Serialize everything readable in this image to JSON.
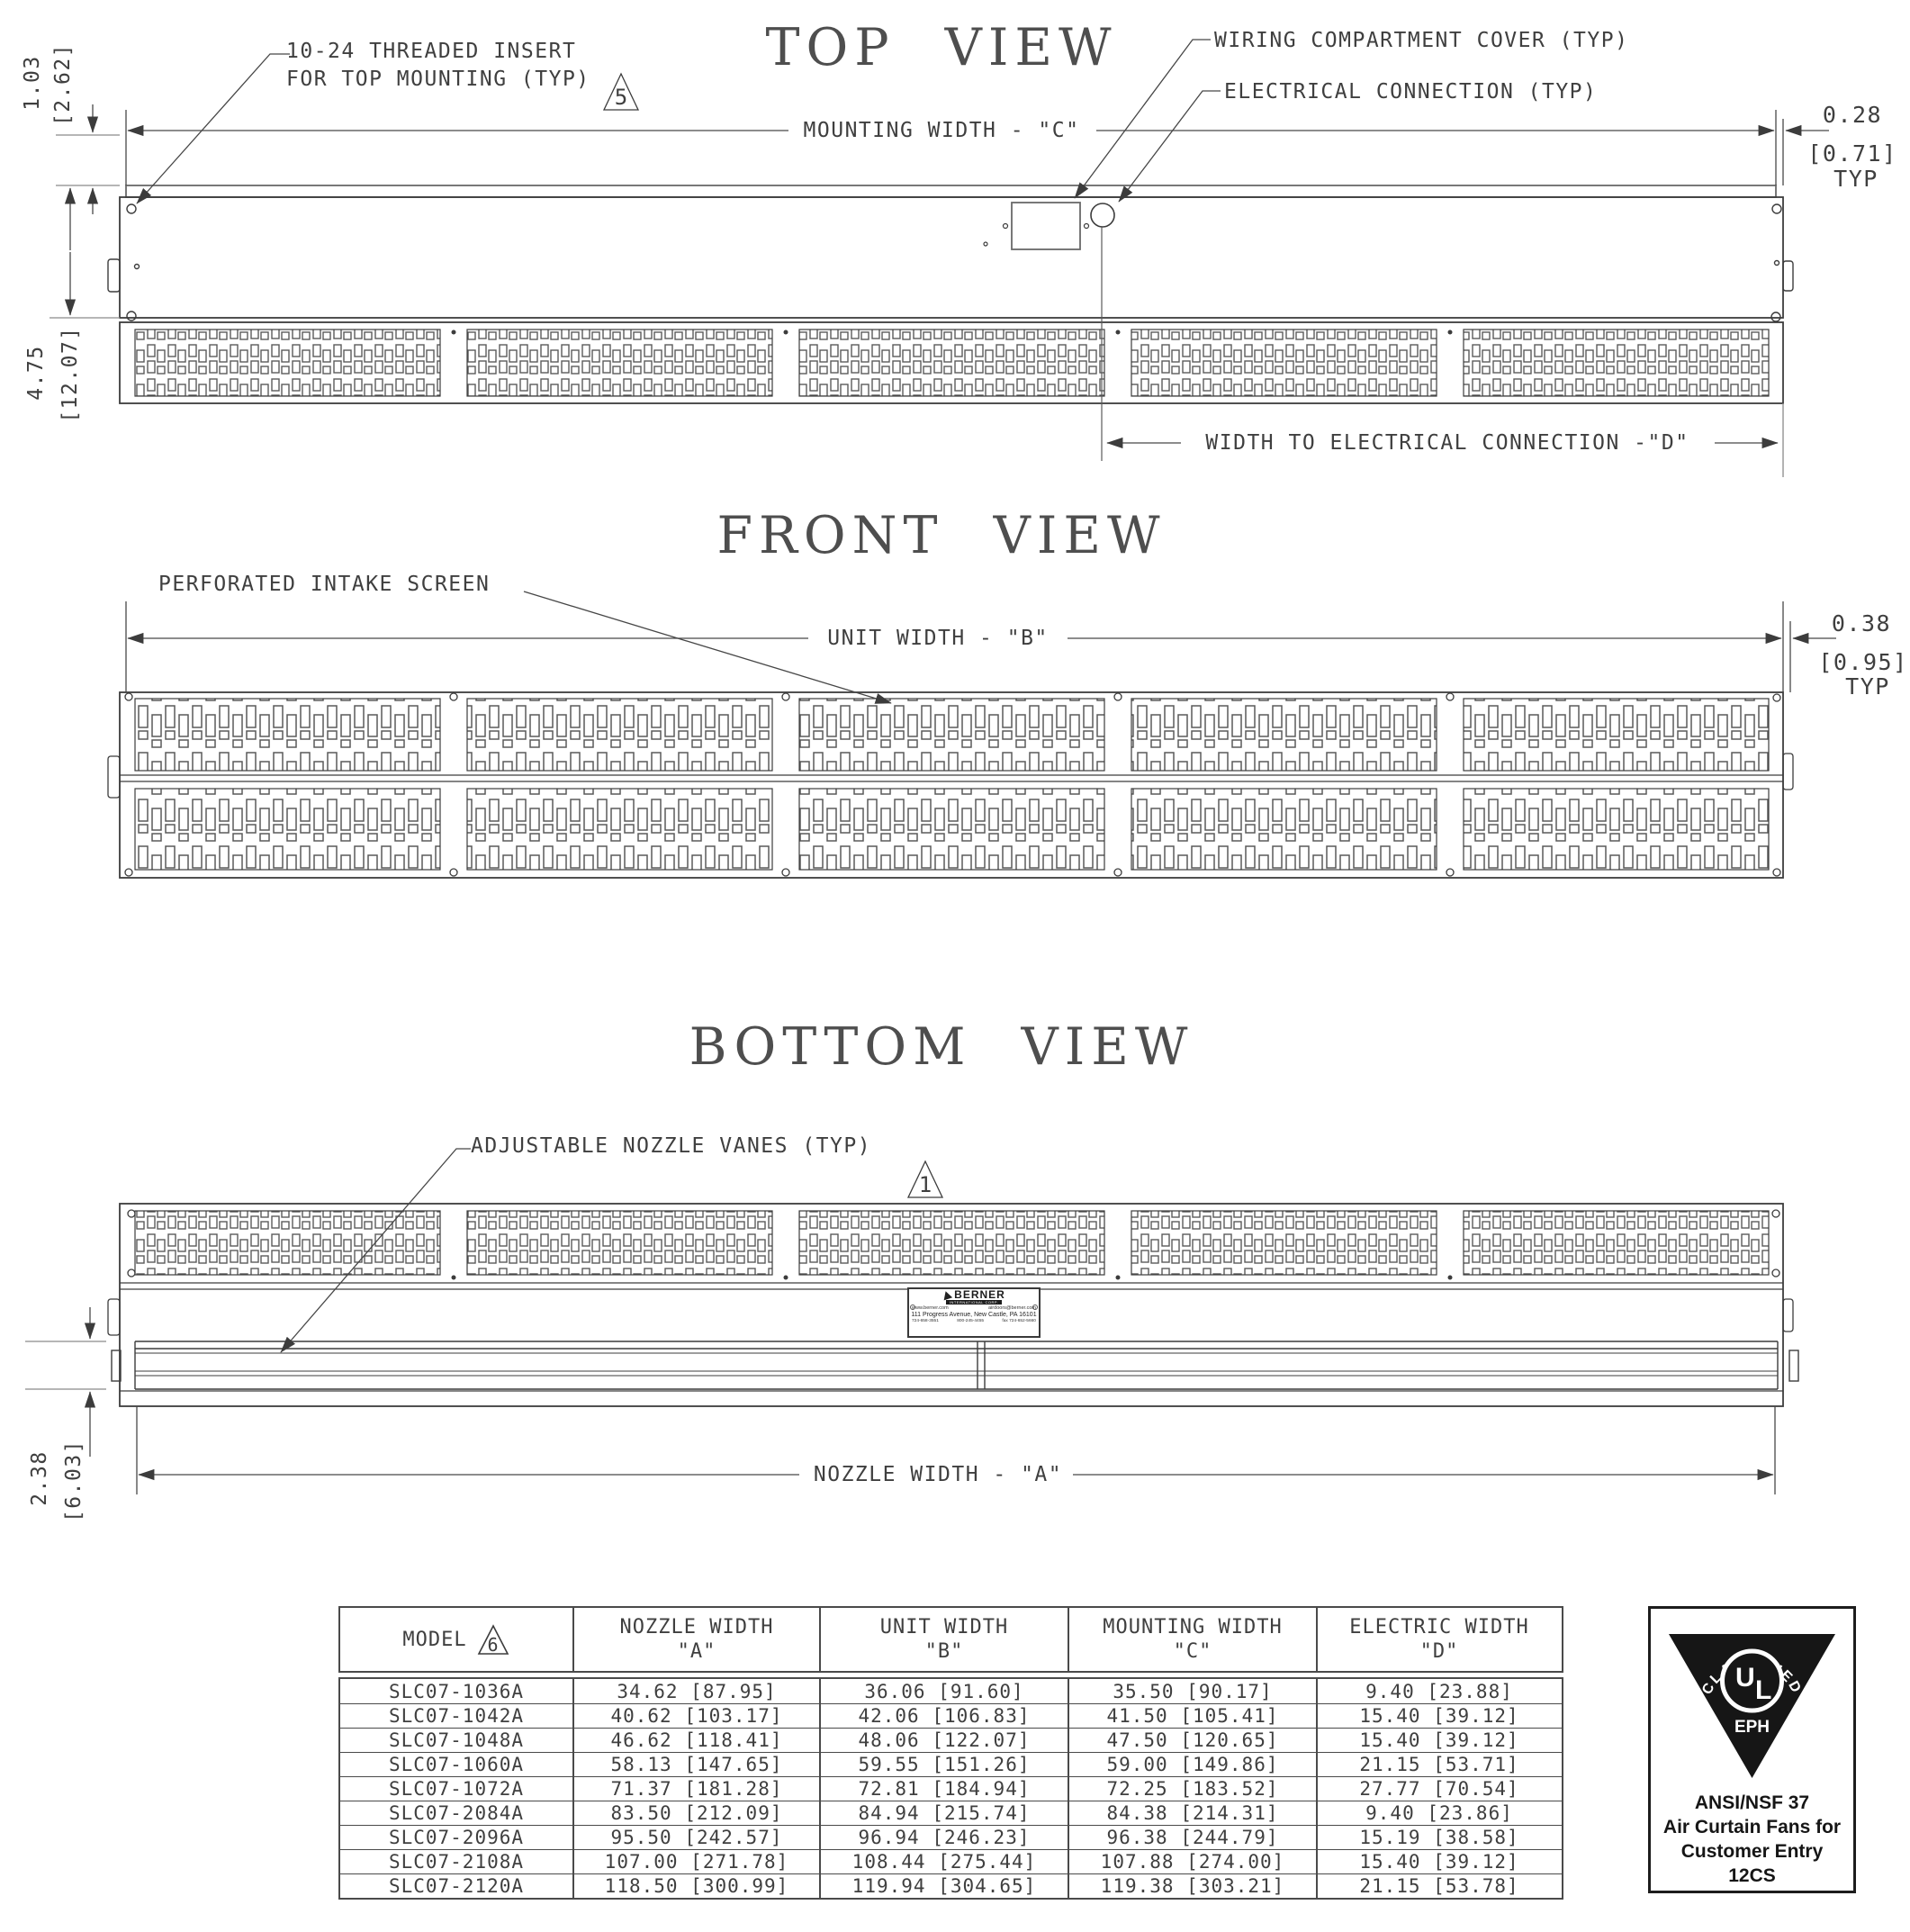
{
  "top_view": {
    "title": "TOP VIEW",
    "note_threaded_1": "10-24 THREADED INSERT",
    "note_threaded_2": "FOR TOP MOUNTING (TYP)",
    "flag_threaded": "5",
    "note_wiring": "WIRING COMPARTMENT COVER (TYP)",
    "note_electrical": "ELECTRICAL CONNECTION (TYP)",
    "dim_mounting_width": "MOUNTING WIDTH - \"C\"",
    "dim_edge_1": "0.28",
    "dim_edge_2": "[0.71]",
    "dim_edge_3": "TYP",
    "dim_top_1": "1.03",
    "dim_top_2": "[2.62]",
    "dim_depth_1": "4.75",
    "dim_depth_2": "[12.07]",
    "dim_electrical": "WIDTH TO ELECTRICAL CONNECTION -\"D\""
  },
  "front_view": {
    "title": "FRONT VIEW",
    "note_screen": "PERFORATED INTAKE SCREEN",
    "dim_unit_width": "UNIT WIDTH - \"B\"",
    "dim_edge_1": "0.38",
    "dim_edge_2": "[0.95]",
    "dim_edge_3": "TYP"
  },
  "bottom_view": {
    "title": "BOTTOM VIEW",
    "note_vanes": "ADJUSTABLE NOZZLE VANES (TYP)",
    "flag_vanes": "1",
    "dim_nozzle_width": "NOZZLE WIDTH - \"A\"",
    "dim_height_1": "2.38",
    "dim_height_2": "[6.03]"
  },
  "nameplate": {
    "brand": "BERNER",
    "brand_sub": "INTERNATIONAL CORP.",
    "website": "www.berner.com",
    "email": "airdoors@berner.com",
    "address": "111 Progress Avenue, New Castle, PA 16101",
    "phone": "724-658-3551",
    "phone2": "800-245-4455",
    "fax": "fax 724-652-5660"
  },
  "table": {
    "col_model": "MODEL",
    "col_model_flag": "6",
    "col_nozzle": "NOZZLE WIDTH",
    "col_nozzle_sub": "\"A\"",
    "col_unit": "UNIT WIDTH",
    "col_unit_sub": "\"B\"",
    "col_mounting": "MOUNTING WIDTH",
    "col_mounting_sub": "\"C\"",
    "col_electric": "ELECTRIC WIDTH",
    "col_electric_sub": "\"D\"",
    "rows": [
      [
        "SLC07-1036A",
        "34.62 [87.95]",
        "36.06 [91.60]",
        "35.50 [90.17]",
        "9.40 [23.88]"
      ],
      [
        "SLC07-1042A",
        "40.62 [103.17]",
        "42.06 [106.83]",
        "41.50 [105.41]",
        "15.40 [39.12]"
      ],
      [
        "SLC07-1048A",
        "46.62 [118.41]",
        "48.06 [122.07]",
        "47.50 [120.65]",
        "15.40 [39.12]"
      ],
      [
        "SLC07-1060A",
        "58.13 [147.65]",
        "59.55 [151.26]",
        "59.00 [149.86]",
        "21.15 [53.71]"
      ],
      [
        "SLC07-1072A",
        "71.37 [181.28]",
        "72.81 [184.94]",
        "72.25 [183.52]",
        "27.77 [70.54]"
      ],
      [
        "SLC07-2084A",
        "83.50 [212.09]",
        "84.94 [215.74]",
        "84.38 [214.31]",
        "9.40 [23.86]"
      ],
      [
        "SLC07-2096A",
        "95.50 [242.57]",
        "96.94 [246.23]",
        "96.38 [244.79]",
        "15.19 [38.58]"
      ],
      [
        "SLC07-2108A",
        "107.00 [271.78]",
        "108.44 [275.44]",
        "107.88 [274.00]",
        "15.40 [39.12]"
      ],
      [
        "SLC07-2120A",
        "118.50 [300.99]",
        "119.94 [304.65]",
        "119.38 [303.21]",
        "21.15 [53.78]"
      ]
    ]
  },
  "ul_badge": {
    "arc": "CLASSIFIED",
    "mark_u": "U",
    "mark_l": "L",
    "eph": "EPH",
    "line1": "ANSI/NSF 37",
    "line2": "Air Curtain Fans for",
    "line3": "Customer Entry",
    "line4": "12CS"
  }
}
